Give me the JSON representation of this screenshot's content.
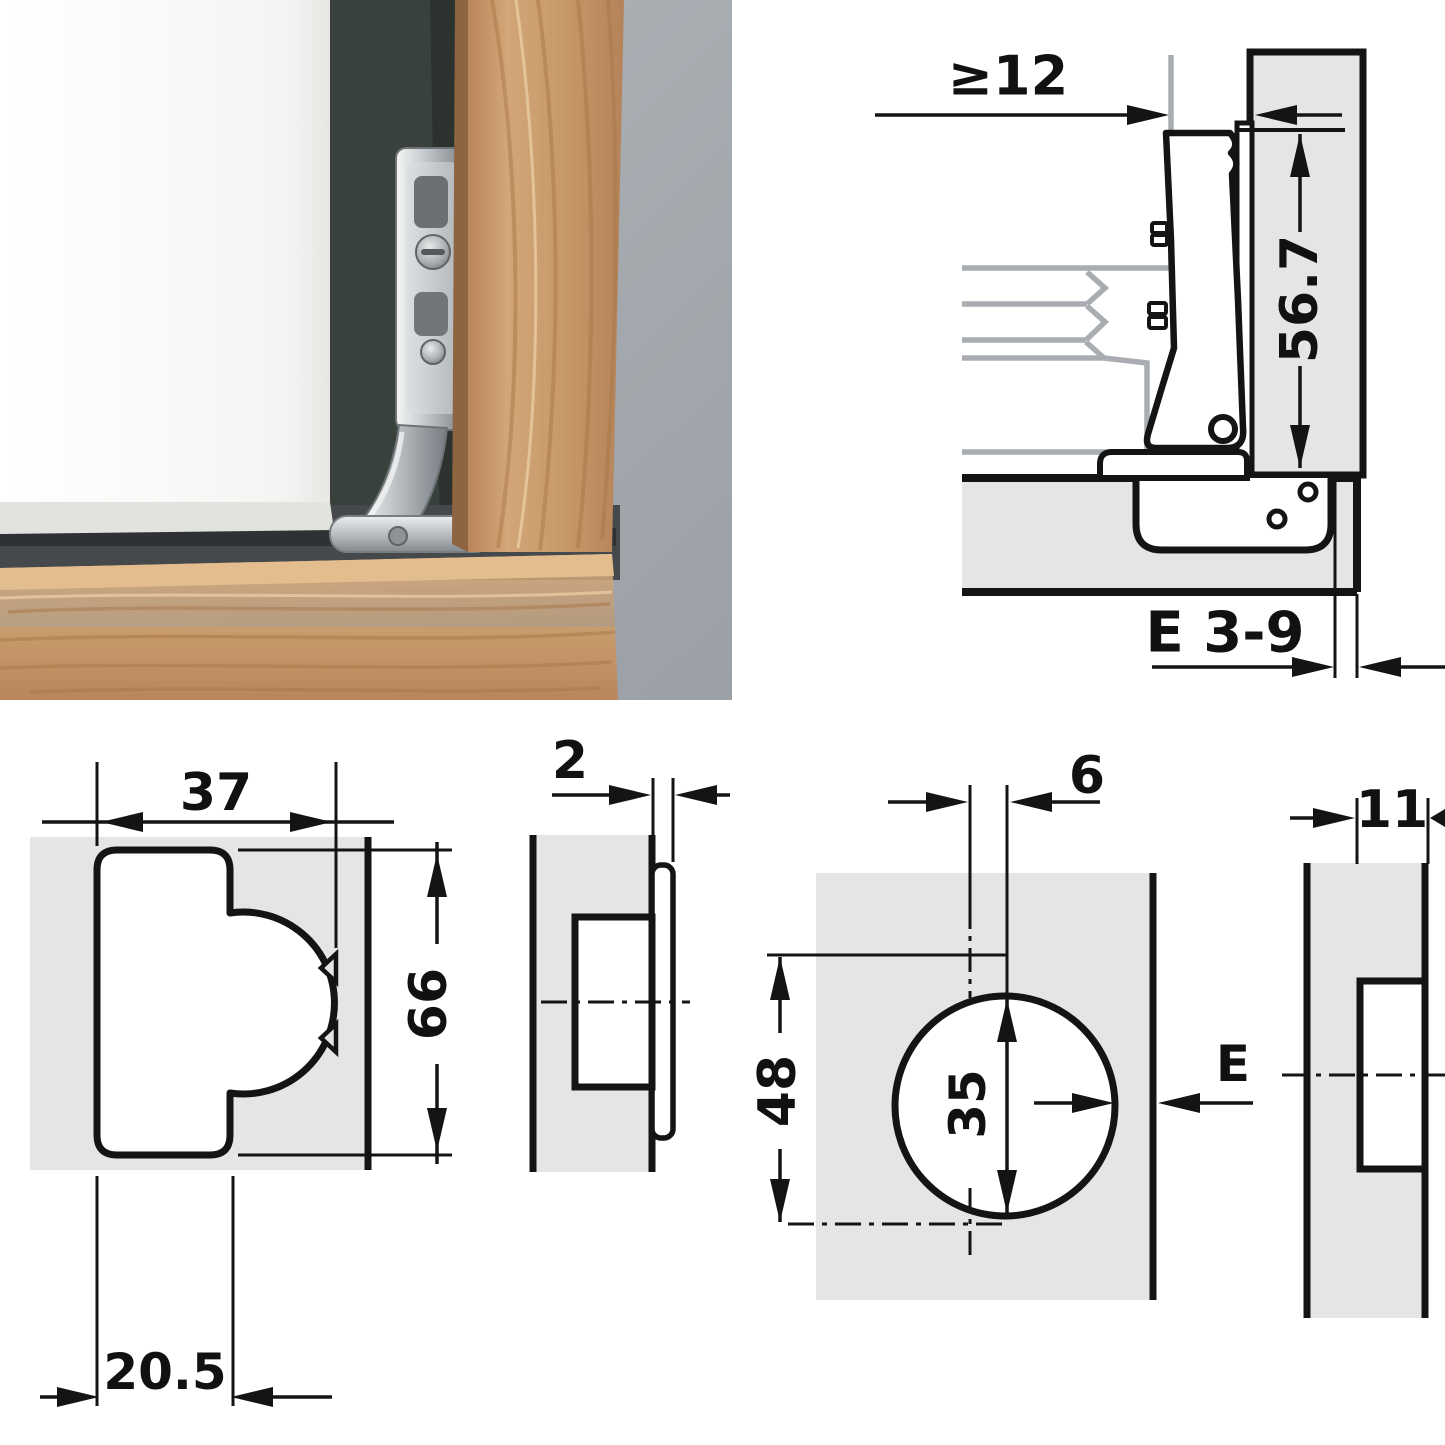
{
  "cross_section": {
    "min_clearance": "≥12",
    "plate_height": "56.7",
    "edge_distance": "E 3-9"
  },
  "routing_pattern": {
    "width": "37",
    "height": "66",
    "offset": "20.5"
  },
  "side_view": {
    "protrusion": "2"
  },
  "drilling_pattern": {
    "center_offset": "6",
    "spacing": "48",
    "cup_diameter": "35",
    "edge_distance": "E"
  },
  "edge_view": {
    "recess_depth": "11"
  },
  "colors": {
    "panel_fill": "#e4e5e7",
    "line_black": "#141414",
    "section_gray": "#a9adb1",
    "photo_background": "#a8adb2",
    "wood": "#c99d6e",
    "door_white": "#fbfbfa"
  }
}
